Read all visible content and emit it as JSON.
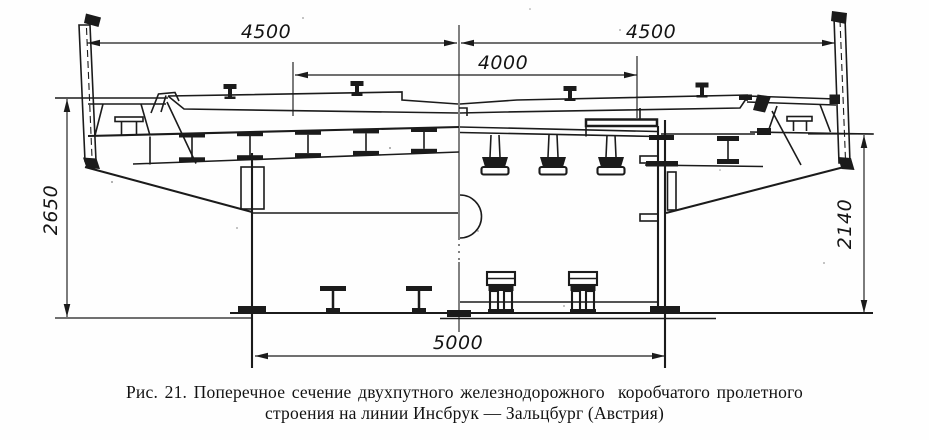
{
  "figure": {
    "caption_line1": "Рис. 21. Поперечное сечение двухпутного железнодорожного  коробчатого пролетного",
    "caption_line2": "строения на линии Инсбрук — Зальцбург (Австрия)"
  },
  "dimensions_mm": {
    "top_left_half": "4500",
    "top_right_half": "4500",
    "track_spacing": "4000",
    "bottom_width": "5000",
    "left_height": "2650",
    "right_height": "2140"
  },
  "style": {
    "ink": "#1b1b1b",
    "paper": "#fefefe"
  }
}
